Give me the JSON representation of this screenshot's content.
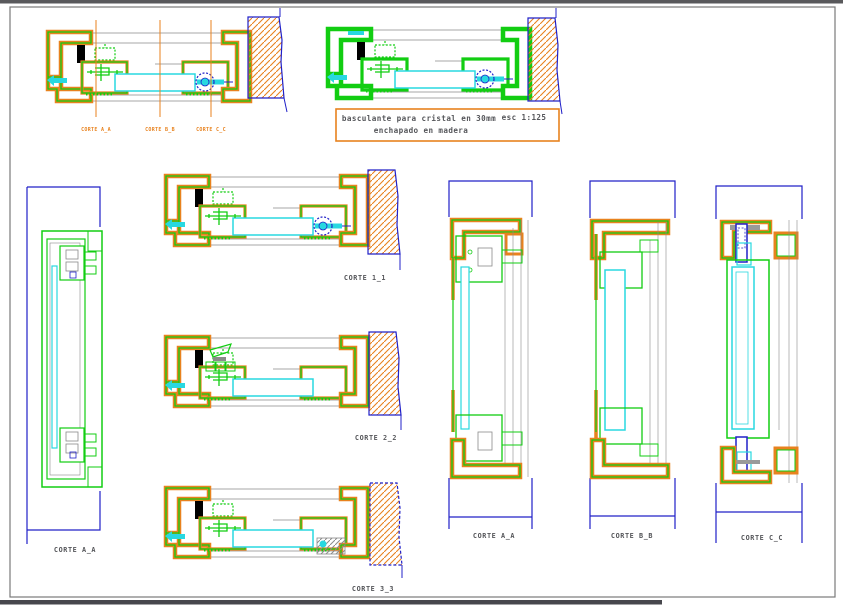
{
  "colors": {
    "orange": "#e8821e",
    "green": "#12cd12",
    "cyan": "#28d8e0",
    "navy": "#2020c8",
    "gray": "#8a8a8a",
    "ink": "#55565a",
    "bartop": "#59595c",
    "barbottom": "#47474d",
    "border": "#7a7a7a"
  },
  "note_box": {
    "line1": "basculante para cristal en 30mm",
    "line2": "enchapado en madera",
    "scale": "esc 1:125"
  },
  "labels": {
    "cut_a": "CORTE A_A",
    "cut_b": "CORTE B_B",
    "cut_c": "CORTE C_C",
    "corte_1": "CORTE 1_1",
    "corte_2": "CORTE 2_2",
    "corte_3": "CORTE 3_3",
    "left_a": "CORTE A_A",
    "right_a": "CORTE A_A",
    "right_b": "CORTE B_B",
    "right_c": "CORTE C_C"
  }
}
